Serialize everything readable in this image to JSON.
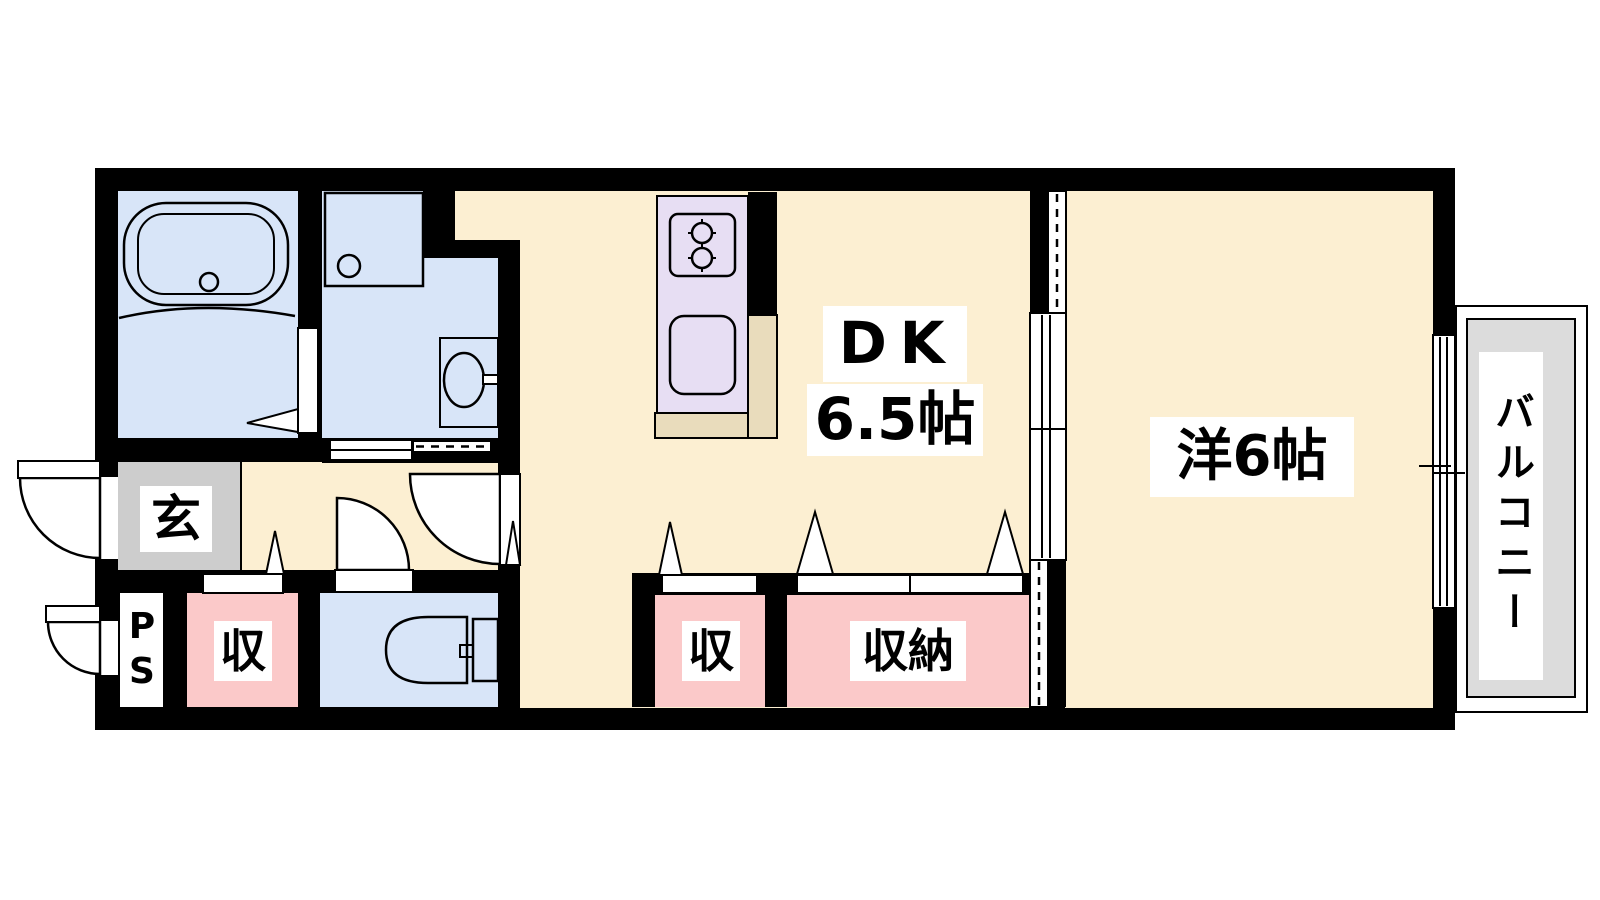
{
  "floorplan": {
    "rooms": {
      "genkan": {
        "label": "玄"
      },
      "pipe_space": {
        "label": "PS"
      },
      "storage_1": {
        "label": "収"
      },
      "storage_2": {
        "label": "収"
      },
      "storage_3": {
        "label": "収納"
      },
      "dining_kitchen": {
        "label": "DK",
        "size": "6.5帖"
      },
      "western_room": {
        "label": "洋6帖"
      },
      "balcony": {
        "label": "バルコニー"
      }
    },
    "colors": {
      "wall": "#000000",
      "floor": "#FCEFD2",
      "wet": "#D8E5F8",
      "closet": "#FBC9C9",
      "kitchen": "#E7DEF3",
      "kitchenBase": "#E9DCBC",
      "genkan": "#CDCDCD",
      "balconyDeck": "#DCDCDC"
    }
  }
}
